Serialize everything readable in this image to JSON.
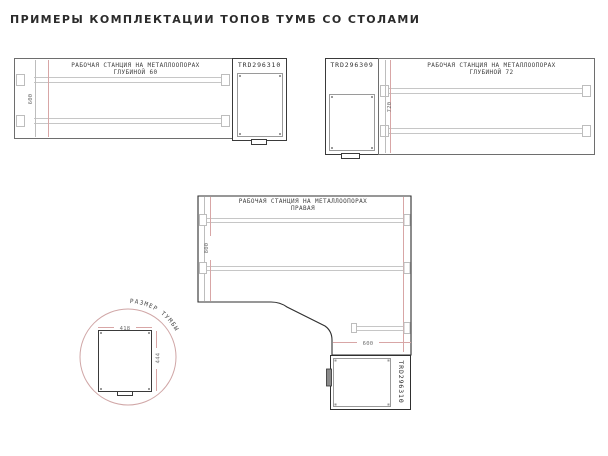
{
  "title": "ПРИМЕРЫ КОМПЛЕКТАЦИИ ТОПОВ ТУМБ СО СТОЛАМИ",
  "colors": {
    "dimension_pink": "#d8a6a6",
    "outline_dark": "#2f2f2f",
    "outline_gray": "#6e6e6e",
    "title_text": "#2b2b2b"
  },
  "diagram_top_left": {
    "station_label_line1": "РАБОЧАЯ СТАНЦИЯ НА МЕТАЛЛООПОРАХ",
    "station_label_line2": "ГЛУБИНОЙ 60",
    "depth_dim": "600",
    "cabinet_code": "TRD296310"
  },
  "diagram_top_right": {
    "cabinet_code": "TRD296309",
    "station_label_line1": "РАБОЧАЯ СТАНЦИЯ НА МЕТАЛЛООПОРАХ",
    "station_label_line2": "ГЛУБИНОЙ 72",
    "depth_dim": "720"
  },
  "diagram_center": {
    "station_label_line1": "РАБОЧАЯ СТАНЦИЯ НА МЕТАЛЛООПОРАХ",
    "station_label_line2": "ПРАВАЯ",
    "height_dim": "800",
    "width_dim": "600",
    "cabinet_code": "TRD296310"
  },
  "cabinet_detail": {
    "caption": "РАЗМЕР ТУМБЫ",
    "width_dim": "418",
    "depth_dim": "444"
  }
}
